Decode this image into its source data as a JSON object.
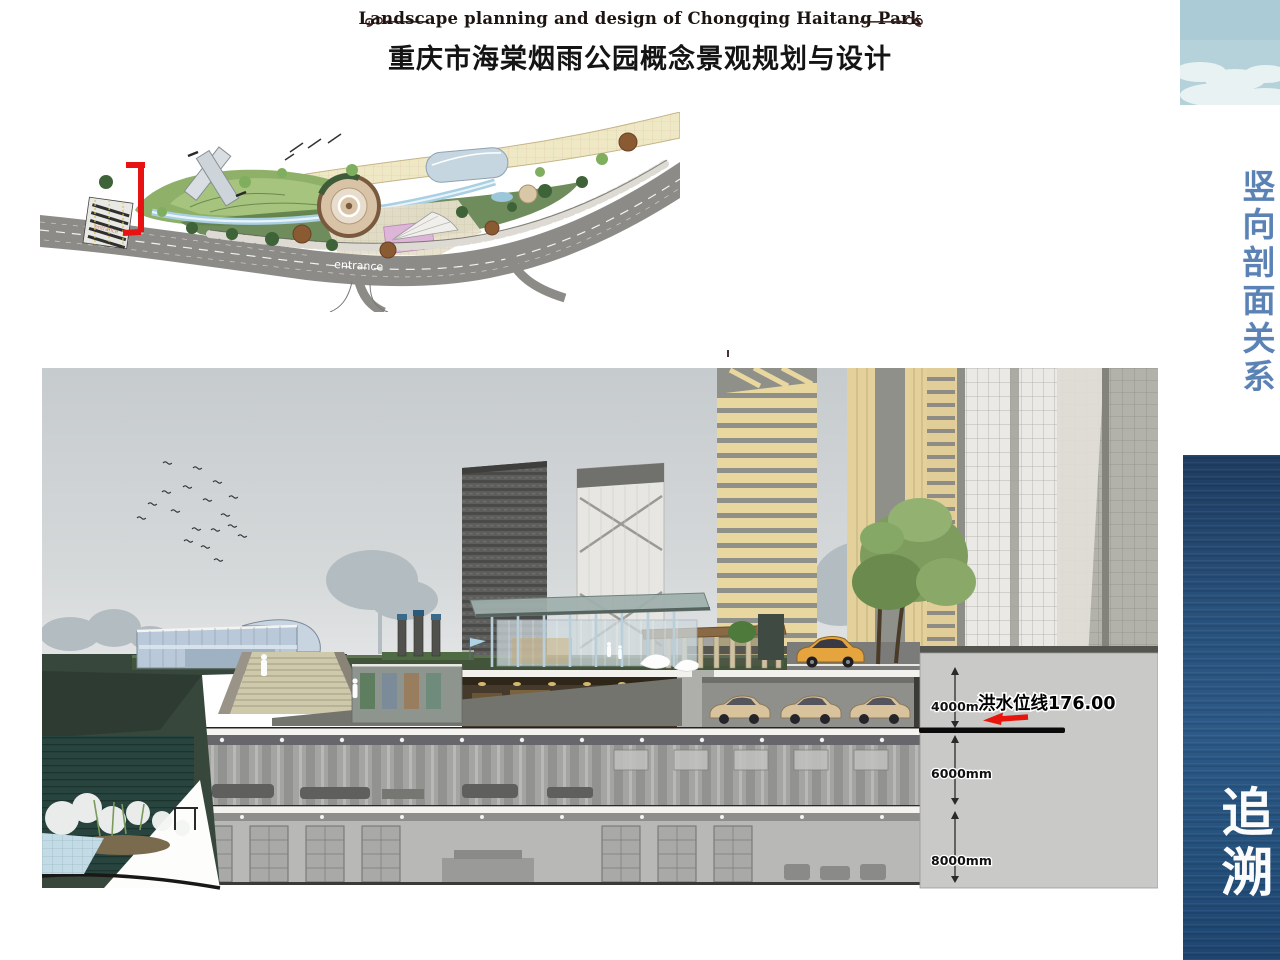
{
  "header": {
    "title_en": "Landscape planning and design of Chongqing Haitang Park",
    "title_zh": "重庆市海棠烟雨公园概念景观规划与设计"
  },
  "site_plan": {
    "entrance_label": "entrance",
    "entrance_label_small": "entrance",
    "section_marker_color": "#e81212"
  },
  "sidebar": {
    "vertical_title": "竖向剖面关系",
    "theme_title": "追溯",
    "title_color": "#5b82b5"
  },
  "section": {
    "flood_line_label": "洪水位线176.00",
    "dim_upper": "4000mm",
    "dim_middle": "6000mm",
    "dim_lower": "8000mm",
    "flood_line_color": "#0a0a0a",
    "marker_color": "#e8150c",
    "panel_color": "#c9c9c7"
  }
}
